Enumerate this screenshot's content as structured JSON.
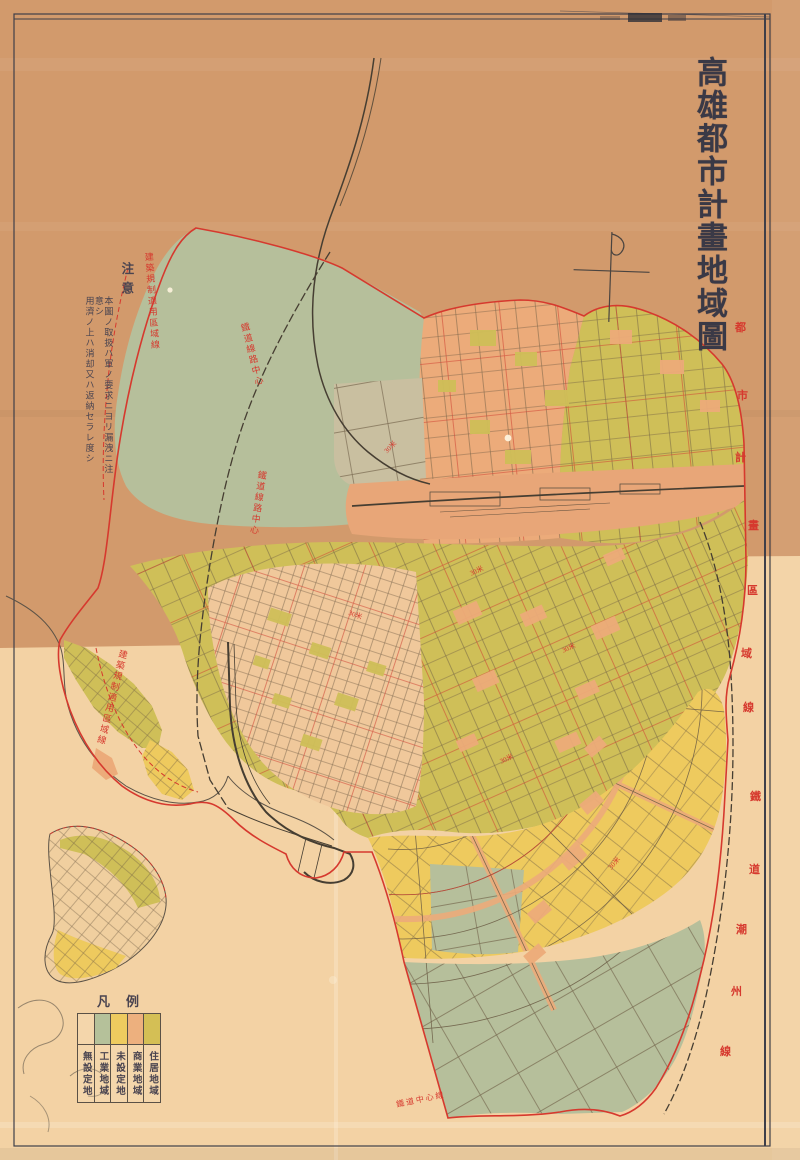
{
  "page": {
    "kind": "scanned historical urban-planning map sheet"
  },
  "title": {
    "text": "高雄都市計畫地域圖"
  },
  "notice": {
    "heading": "注意",
    "lines": [
      "本圖ノ取扱ハ軍ノ要求ニヨリ漏洩ニ注意シ",
      "用濟ノ上ハ消却又ハ返納セラレ度シ"
    ]
  },
  "legend": {
    "title": "凡例",
    "items": [
      {
        "label": "無設定地",
        "color": ""
      },
      {
        "label": "工業地域",
        "color": "#b5c19a"
      },
      {
        "label": "未設定地",
        "color": "#eecb5f"
      },
      {
        "label": "商業地域",
        "color": "#edb07e"
      },
      {
        "label": "住居地域",
        "color": "#d4bf55"
      }
    ]
  },
  "map_labels": {
    "regulation_line_left": "建築規制適用區域線",
    "regulation_line_harbor": "建築規制適用區域線",
    "railway_center_1": "鐵道線路中心",
    "railway_center_2": "鐵道線路中心",
    "railway_bottom": "鐵道中心線",
    "boundary_chars": [
      "都",
      "市",
      "計",
      "畫",
      "區",
      "域",
      "線"
    ],
    "railway_chars": [
      "鐵",
      "道",
      "潮",
      "州",
      "線"
    ],
    "road_width": "30米"
  },
  "compass": {
    "name": "magnetic-north-symbol"
  },
  "colors": {
    "paper_top": "#d29a6c",
    "paper_bottom": "#f3d2a4",
    "residential_olive": "#cfbf58",
    "commercial_salmon": "#ecab7a",
    "undesignated_yellow": "#eeca5e",
    "industrial_green": "#b6bf9b",
    "station_tan": "#c9bfa0",
    "oldtown_peach": "#f0c89b",
    "boundary_red": "#d6392e",
    "ink": "#3e3a44",
    "line_dark": "#5e5142"
  }
}
